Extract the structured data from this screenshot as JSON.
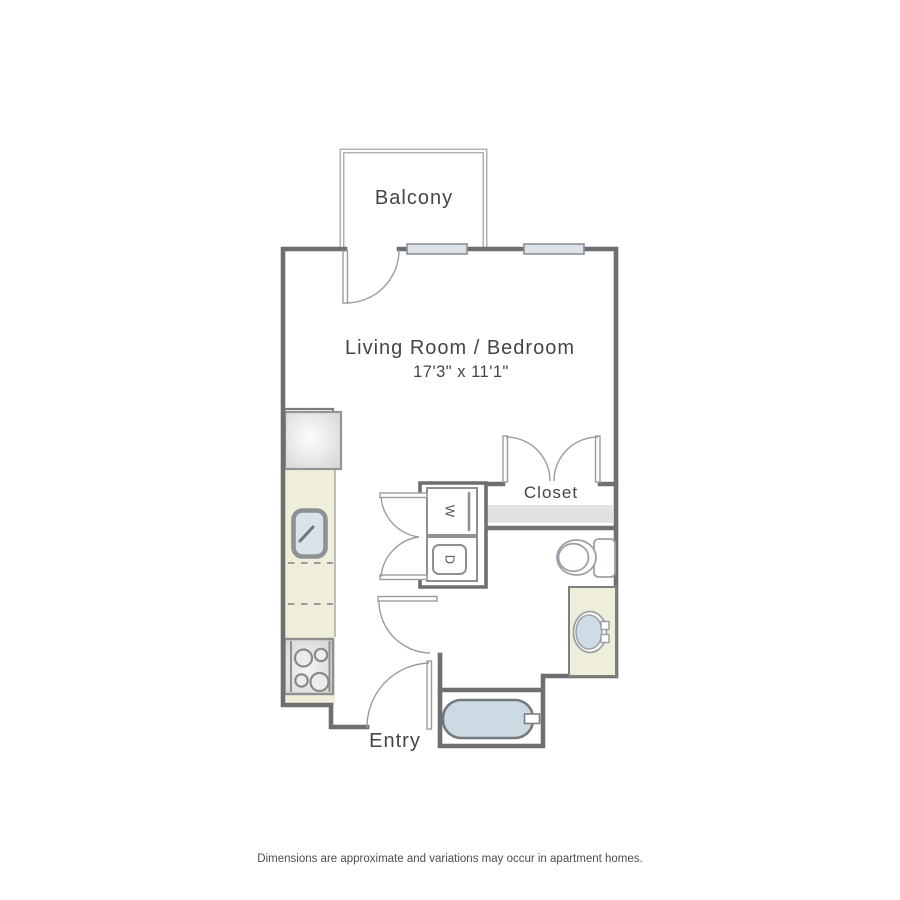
{
  "floor_plan": {
    "rooms": {
      "balcony_label": "Balcony",
      "living_room_label": "Living Room / Bedroom",
      "living_room_dimensions": "17'3\" x 11'1\"",
      "closet_label": "Closet",
      "entry_label": "Entry"
    },
    "appliances": {
      "washer_label": "W",
      "dryer_label": "D"
    },
    "disclaimer_text": "Dimensions are approximate and variations may occur in apartment homes.",
    "colors": {
      "wall": "#6f6f6f",
      "balcony_wall": "#a6a6a6",
      "counter": "#efeeda",
      "vanity": "#eeeedb",
      "water_fill": "#ccdae3",
      "window_fill": "#dbe3e9",
      "shelf_fill": "#e2e2e2",
      "label_text": "#454545"
    }
  }
}
